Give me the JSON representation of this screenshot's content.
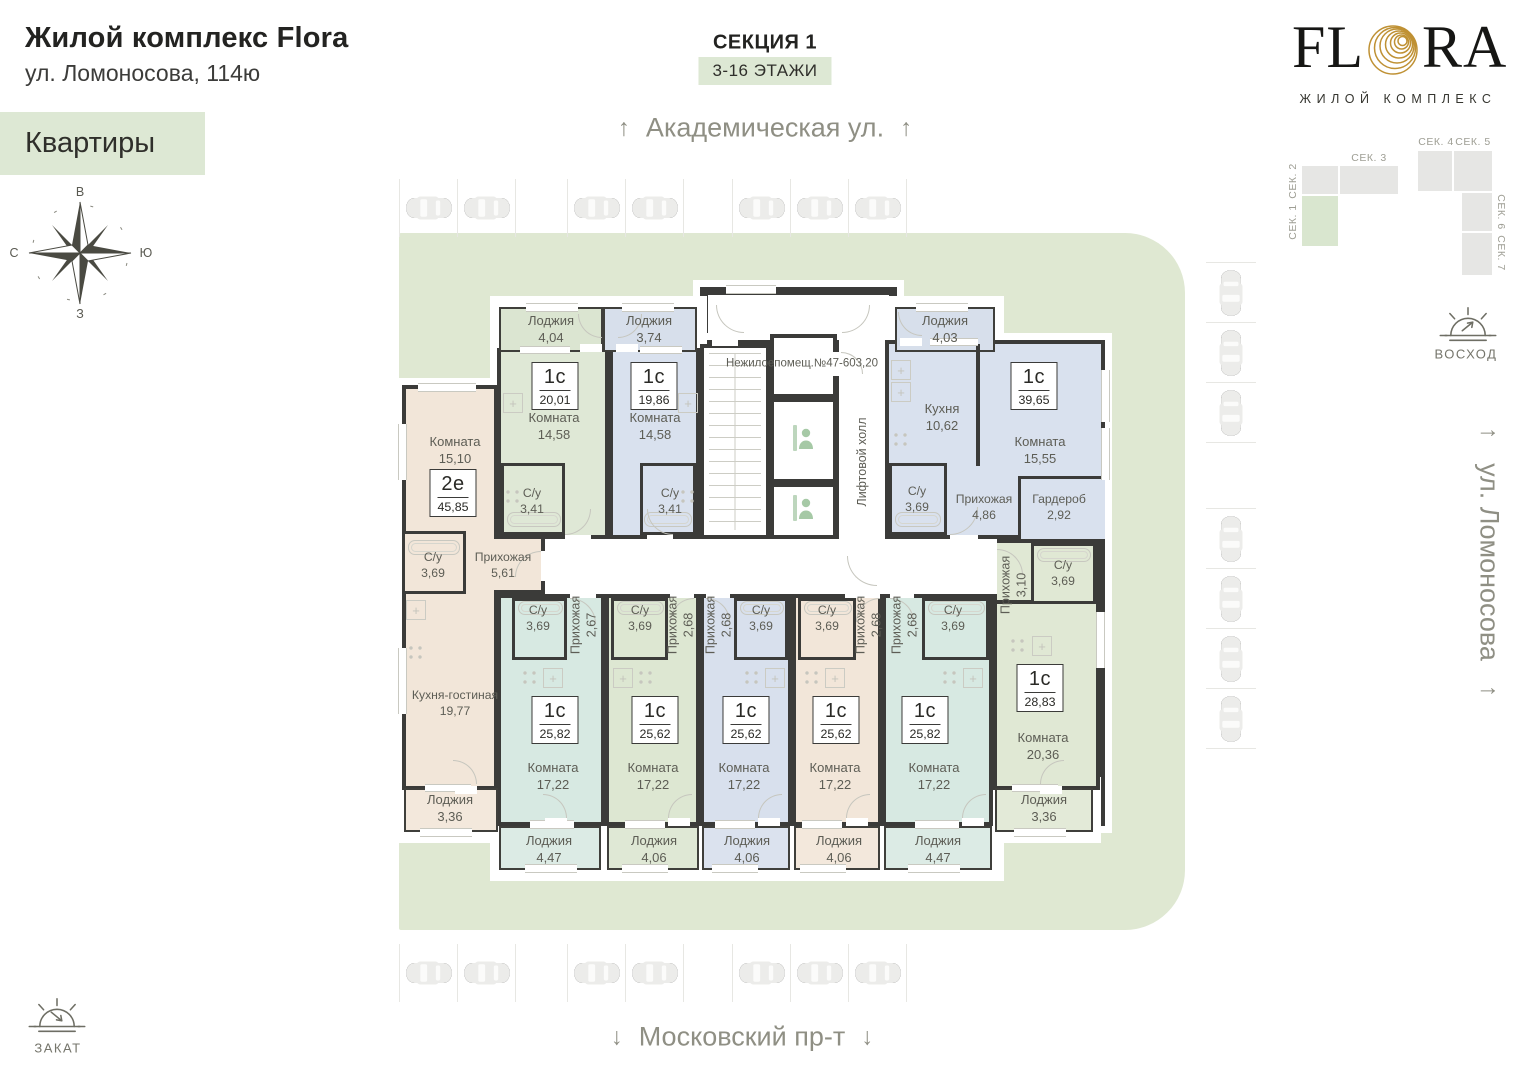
{
  "header": {
    "title": "Жилой комплекс Flora",
    "address": "ул. Ломоносова, 114ю",
    "tab": "Квартиры"
  },
  "section": {
    "title": "СЕКЦИЯ 1",
    "floors": "3-16 ЭТАЖИ"
  },
  "streets": {
    "top": "Академическая ул.",
    "bottom": "Московский пр-т",
    "right": "ул. Ломоносова",
    "up": "↑",
    "down": "↓"
  },
  "compass": {
    "top": "В",
    "right": "Ю",
    "bottom": "З",
    "left": "С"
  },
  "logo": {
    "left": "FL",
    "right": "RA",
    "subtitle": "ЖИЛОЙ КОМПЛЕКС"
  },
  "sun": {
    "sunrise": "ВОСХОД",
    "sunset": "ЗАКАТ"
  },
  "sitemap": {
    "labels": [
      "СЕК. 1",
      "СЕК. 2",
      "СЕК. 3",
      "СЕК. 4",
      "СЕК. 5",
      "СЕК. 6",
      "СЕК. 7"
    ],
    "highlighted": "СЕК. 1"
  },
  "core": {
    "nr1": "Нежилое",
    "nr2": "помещ.",
    "nr3": "№47-60",
    "nr4": "3,20",
    "hall": "Лифтовой холл"
  },
  "badges": {
    "a1": {
      "type": "1с",
      "area": "20,01"
    },
    "a2": {
      "type": "1с",
      "area": "19,86"
    },
    "e2": {
      "type": "2е",
      "area": "45,85"
    },
    "a4": {
      "type": "1с",
      "area": "39,65"
    },
    "b1": {
      "type": "1с",
      "area": "25,82"
    },
    "b2": {
      "type": "1с",
      "area": "25,62"
    },
    "b3": {
      "type": "1с",
      "area": "25,62"
    },
    "b4": {
      "type": "1с",
      "area": "25,62"
    },
    "b5": {
      "type": "1с",
      "area": "25,82"
    },
    "r": {
      "type": "1с",
      "area": "28,83"
    }
  },
  "rooms": {
    "l404": {
      "name": "Лоджия",
      "area": "4,04"
    },
    "l374": {
      "name": "Лоджия",
      "area": "3,74"
    },
    "l403": {
      "name": "Лоджия",
      "area": "4,03"
    },
    "a1_room": {
      "name": "Комната",
      "area": "14,58"
    },
    "a1_su": {
      "name": "С/у",
      "area": "3,41"
    },
    "a2_room": {
      "name": "Комната",
      "area": "14,58"
    },
    "a2_su": {
      "name": "С/у",
      "area": "3,41"
    },
    "e2_room": {
      "name": "Комната",
      "area": "15,10"
    },
    "e2_su": {
      "name": "С/у",
      "area": "3,69"
    },
    "e2_hall": {
      "name": "Прихожая",
      "area": "5,61"
    },
    "e2_kitchen": {
      "name": "Кухня-гостиная",
      "area": "19,77"
    },
    "e2_lodge": {
      "name": "Лоджия",
      "area": "3,36"
    },
    "a4_kitchen": {
      "name": "Кухня",
      "area": "10,62"
    },
    "a4_room": {
      "name": "Комната",
      "area": "15,55"
    },
    "a4_su": {
      "name": "С/у",
      "area": "3,69"
    },
    "a4_hall": {
      "name": "Прихожая",
      "area": "4,86"
    },
    "a4_ward": {
      "name": "Гардероб",
      "area": "2,92"
    },
    "b1_su": {
      "name": "С/у",
      "area": "3,69"
    },
    "b1_hall": {
      "name": "Прихожая",
      "area": "2,67"
    },
    "b1_room": {
      "name": "Комната",
      "area": "17,22"
    },
    "b1_lodge": {
      "name": "Лоджия",
      "area": "4,47"
    },
    "b2_su": {
      "name": "С/у",
      "area": "3,69"
    },
    "b2_hall": {
      "name": "Прихожая",
      "area": "2,68"
    },
    "b2_room": {
      "name": "Комната",
      "area": "17,22"
    },
    "b2_lodge": {
      "name": "Лоджия",
      "area": "4,06"
    },
    "b3_su": {
      "name": "С/у",
      "area": "3,69"
    },
    "b3_hall": {
      "name": "Прихожая",
      "area": "2,68"
    },
    "b3_room": {
      "name": "Комната",
      "area": "17,22"
    },
    "b3_lodge": {
      "name": "Лоджия",
      "area": "4,06"
    },
    "b4_su": {
      "name": "С/у",
      "area": "3,69"
    },
    "b4_hall": {
      "name": "Прихожая",
      "area": "2,68"
    },
    "b4_room": {
      "name": "Комната",
      "area": "17,22"
    },
    "b4_lodge": {
      "name": "Лоджия",
      "area": "4,06"
    },
    "b5_su": {
      "name": "С/у",
      "area": "3,69"
    },
    "b5_hall": {
      "name": "Прихожая",
      "area": "2,68"
    },
    "b5_room": {
      "name": "Комната",
      "area": "17,22"
    },
    "b5_lodge": {
      "name": "Лоджия",
      "area": "4,47"
    },
    "r_hall": {
      "name": "Прихожая",
      "area": "3,10"
    },
    "r_su": {
      "name": "С/у",
      "area": "3,69"
    },
    "r_room": {
      "name": "Комната",
      "area": "20,36"
    },
    "r_lodge": {
      "name": "Лоджия",
      "area": "3,36"
    }
  },
  "colors": {
    "sage": "#dfe8d2",
    "wall": "#3b3b39",
    "gold": "#bf9134",
    "mint": "#d7e9e2",
    "green": "#dde7d2",
    "blue": "#d8e0ed",
    "beige": "#f2e6d9",
    "pale_green": "#e0e8d4"
  }
}
